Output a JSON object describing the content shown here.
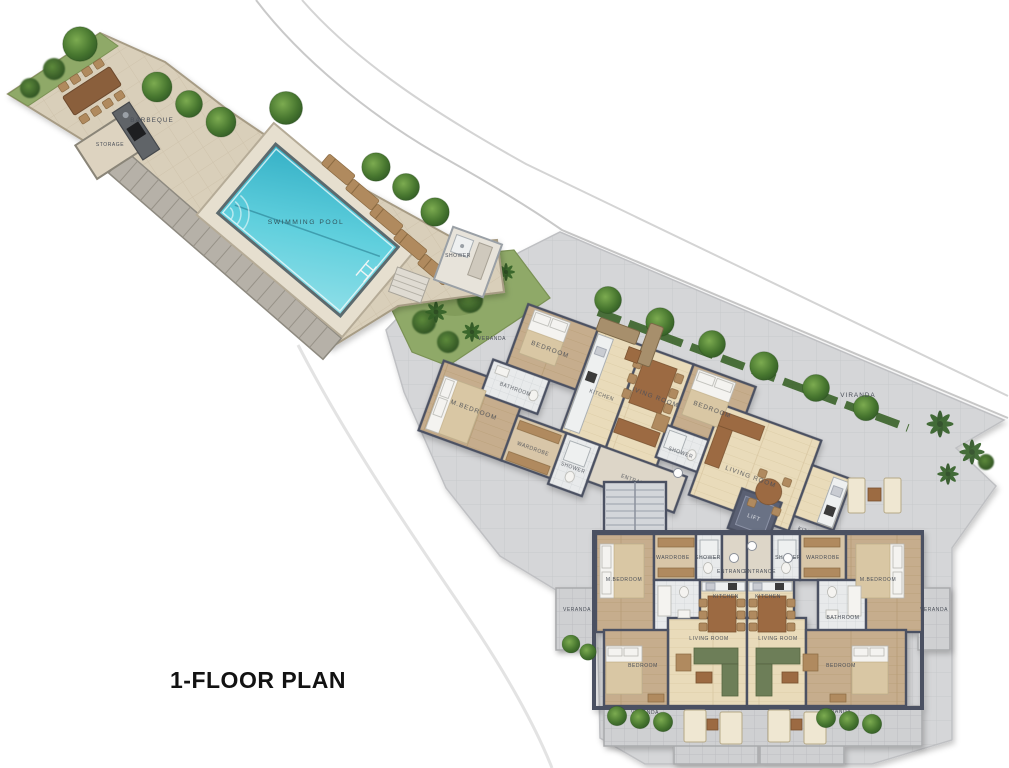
{
  "title": "1-FLOOR PLAN",
  "labels": {
    "barbeque": "BARBEQUE",
    "storage": "STORAGE",
    "swimming_pool": "SWIMMING POOL",
    "shower_pool": "SHOWER",
    "veranda_garden": "VERANDA",
    "u1_bedroom": "BEDROOM",
    "u1_bathroom": "BATHROOM",
    "u1_mbedroom": "M.BEDROOM",
    "u1_wardrobe": "WARDROBE",
    "u1_shower": "SHOWER",
    "u1_kitchen": "KITCHEN",
    "u1_living": "LIVING ROOM",
    "u1_entrance": "ENTRANCE",
    "u2_bedroom": "BEDROOM",
    "u2_shower": "SHOWER",
    "u2_living": "LIVING ROOM",
    "u2_kitchen": "KITCHEN",
    "u2_viranda": "VIRANDA",
    "lift": "LIFT",
    "u3_mbedroom": "M.BEDROOM",
    "u3_wardrobe": "WARDROBE",
    "u3_shower": "SHOWER",
    "u3_entrance": "ENTRANCE",
    "u3_kitchen": "KITCHEN",
    "u3_living": "LIVING ROOM",
    "u3_bedroom": "BEDROOM",
    "u3_veranda_side": "VERANDA",
    "u3_veranda_bottom": "VERANDA",
    "u4_mbedroom": "M.BEDROOM",
    "u4_wardrobe": "WARDROBE",
    "u4_shower": "SHOWER",
    "u4_entrance": "ENTRANCE",
    "u4_kitchen": "KITCHEN",
    "u4_living": "LIVING ROOM",
    "u4_bedroom": "BEDROOM",
    "u4_bathroom": "BATHROOM",
    "u4_veranda_side": "VERANDA",
    "u4_veranda_bottom": "VERANDA"
  },
  "colors": {
    "pool_water": "#4cc6d6",
    "terrace_paving": "#d9cfba",
    "site_paving": "#d5d6d8",
    "walls": "#4b5162",
    "greenery": "#3f6b2e",
    "wood_light": "#e9dbba",
    "wood_dark": "#c6ad8d",
    "sofa_green": "#6d7e58",
    "furniture_brown": "#9c6b42",
    "title_text": "#121212",
    "label_text": "#4a4f58"
  }
}
